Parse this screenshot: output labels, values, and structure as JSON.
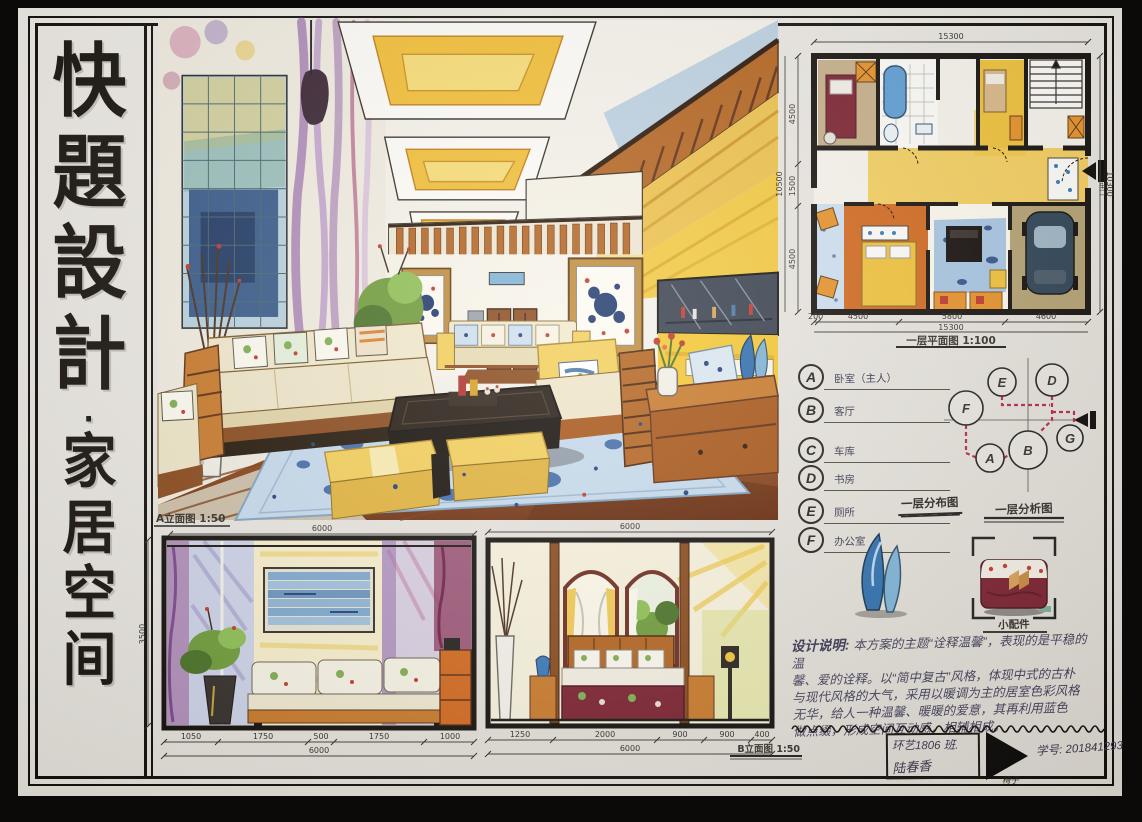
{
  "board": {
    "title_chars": [
      "快",
      "題",
      "設",
      "計",
      "·",
      "家",
      "居",
      "空",
      "间"
    ],
    "title_full": "快題設計·家居空间"
  },
  "floor_plan": {
    "title": "一层平面图 1:100",
    "dim_top": "15300",
    "dim_right": "10300",
    "dim_left_total": "10500",
    "dims_left": [
      "4500",
      "1500",
      "4500"
    ],
    "dims_bottom": [
      "200",
      "4500",
      "5800",
      "4600"
    ],
    "dim_bottom_total": "15300",
    "entry_label": "进口"
  },
  "legend": {
    "caption": "一层分布图",
    "items": [
      {
        "key": "A",
        "label": "卧室（主人）"
      },
      {
        "key": "B",
        "label": "客厅"
      },
      {
        "key": "C",
        "label": "车库"
      },
      {
        "key": "D",
        "label": "书房"
      },
      {
        "key": "E",
        "label": "厕所"
      },
      {
        "key": "F",
        "label": "办公室"
      }
    ]
  },
  "bubble_diagram": {
    "caption": "一层分析图",
    "nodes": [
      "E",
      "D",
      "F",
      "A",
      "B",
      "G"
    ]
  },
  "elevation_a": {
    "title": "A立面图 1:50",
    "dim_top": "6000",
    "dim_left": "3500",
    "dims_bottom": [
      "1050",
      "1750",
      "500",
      "1750",
      "1000"
    ],
    "dim_bottom_total": "6000"
  },
  "elevation_b": {
    "title": "B立面图 1:50",
    "dim_top": "6000",
    "dims_bottom": [
      "1250",
      "2000",
      "900",
      "900",
      "400"
    ],
    "dim_bottom_total": "6000"
  },
  "accessories": {
    "caption": "小配件"
  },
  "description": {
    "heading": "设计说明:",
    "lines": [
      "本方案的主题“诠释温馨”，表现的是平稳的温",
      "馨、爱的诠释。以“简中复古”风格，体现中式的古朴",
      "与现代风格的大气，采用以暖调为主的居室色彩风格",
      "无华，给人一种温馨、暖暖的爱意，其再利用蓝色",
      "做点缀，形成空间互动感，相辅相成。"
    ]
  },
  "signature": {
    "class_line": "环艺1806 班.",
    "name": "陆春香",
    "logo_label": "椅子",
    "student_id": "学号: 201841293"
  },
  "colors": {
    "paper": "#e9e6e0",
    "ink": "#17120d",
    "marker_yellow": "#f2c53d",
    "marker_orange": "#c97a2b",
    "wood_floor": "#a8541f",
    "marker_blue": "#7fa8cc",
    "navy_accent": "#24407c",
    "red_dashed": "#b5294e",
    "curtain_purple": "#9b6fae"
  }
}
